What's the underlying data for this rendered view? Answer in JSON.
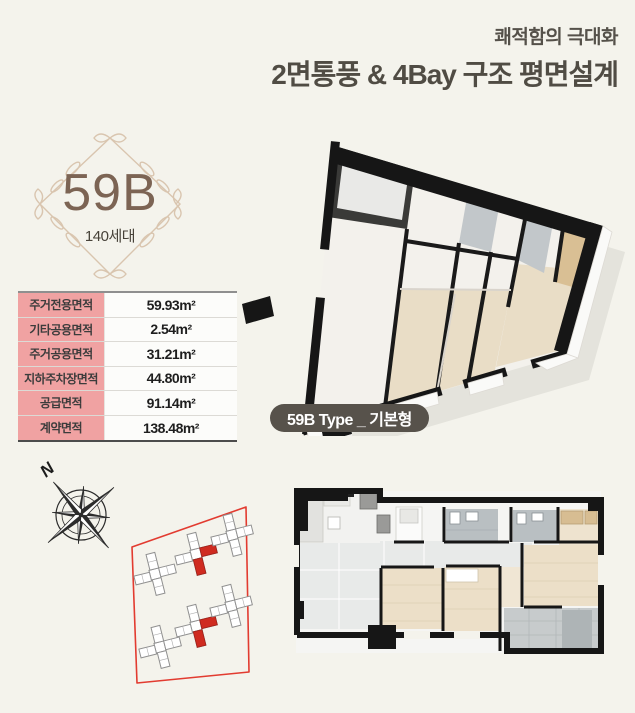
{
  "header": {
    "subtitle": "쾌적함의 극대화",
    "title": "2면통풍 & 4Bay 구조 평면설계",
    "text_color": "#55514a"
  },
  "badge": {
    "unit_type": "59B",
    "households": "140세대",
    "accent_color": "#7c6454",
    "ornament_color": "#d9c5af"
  },
  "area_table": {
    "label_bg": "#f0a2a2",
    "rows": [
      {
        "label": "주거전용면적",
        "value": "59.93m²"
      },
      {
        "label": "기타공용면적",
        "value": "2.54m²"
      },
      {
        "label": "주거공용면적",
        "value": "31.21m²"
      },
      {
        "label": "지하주차장면적",
        "value": "44.80m²"
      },
      {
        "label": "공급면적",
        "value": "91.14m²"
      },
      {
        "label": "계약면적",
        "value": "138.48m²"
      }
    ]
  },
  "type_label": {
    "text": "59B Type _ 기본형",
    "bg": "#57524b"
  },
  "site": {
    "compass_label": "N",
    "boundary_color": "#e23b30",
    "highlight_color": "#cf2b20"
  }
}
